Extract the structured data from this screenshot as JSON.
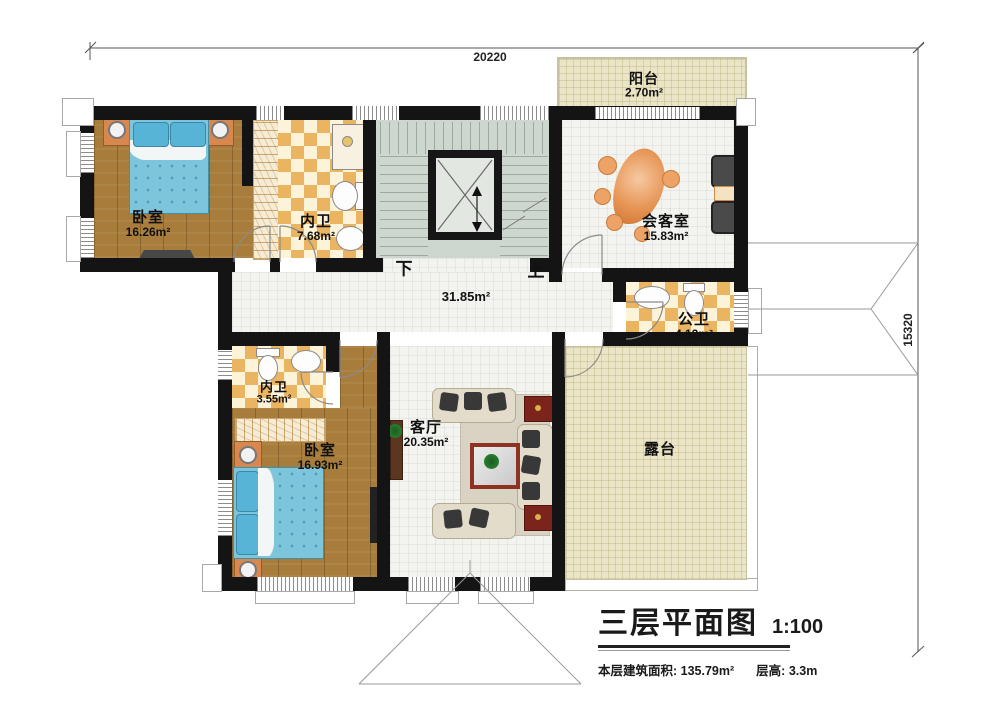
{
  "dimensions": {
    "width_mm": "20220",
    "height_mm": "15320"
  },
  "rooms": {
    "bedroom_nw": {
      "name": "卧室",
      "area": "16.26m²"
    },
    "bath_nw": {
      "name": "内卫",
      "area": "7.68m²"
    },
    "balcony": {
      "name": "阳台",
      "area": "2.70m²"
    },
    "reception": {
      "name": "会客室",
      "area": "15.83m²"
    },
    "public_bath": {
      "name": "公卫",
      "area": "4.12m²"
    },
    "bath_sw": {
      "name": "内卫",
      "area": "3.55m²"
    },
    "bedroom_sw": {
      "name": "卧室",
      "area": "16.93m²"
    },
    "living": {
      "name": "客厅",
      "area": "20.35m²"
    },
    "terrace": {
      "name": "露台"
    },
    "hall": {
      "area": "31.85m²"
    }
  },
  "stairs": {
    "down": "下",
    "up": "上"
  },
  "title": {
    "heading": "三层平面图",
    "scale": "1:100",
    "floor_area_label": "本层建筑面积:",
    "floor_area_value": "135.79m²",
    "floor_height_label": "层高:",
    "floor_height_value": "3.3m"
  }
}
